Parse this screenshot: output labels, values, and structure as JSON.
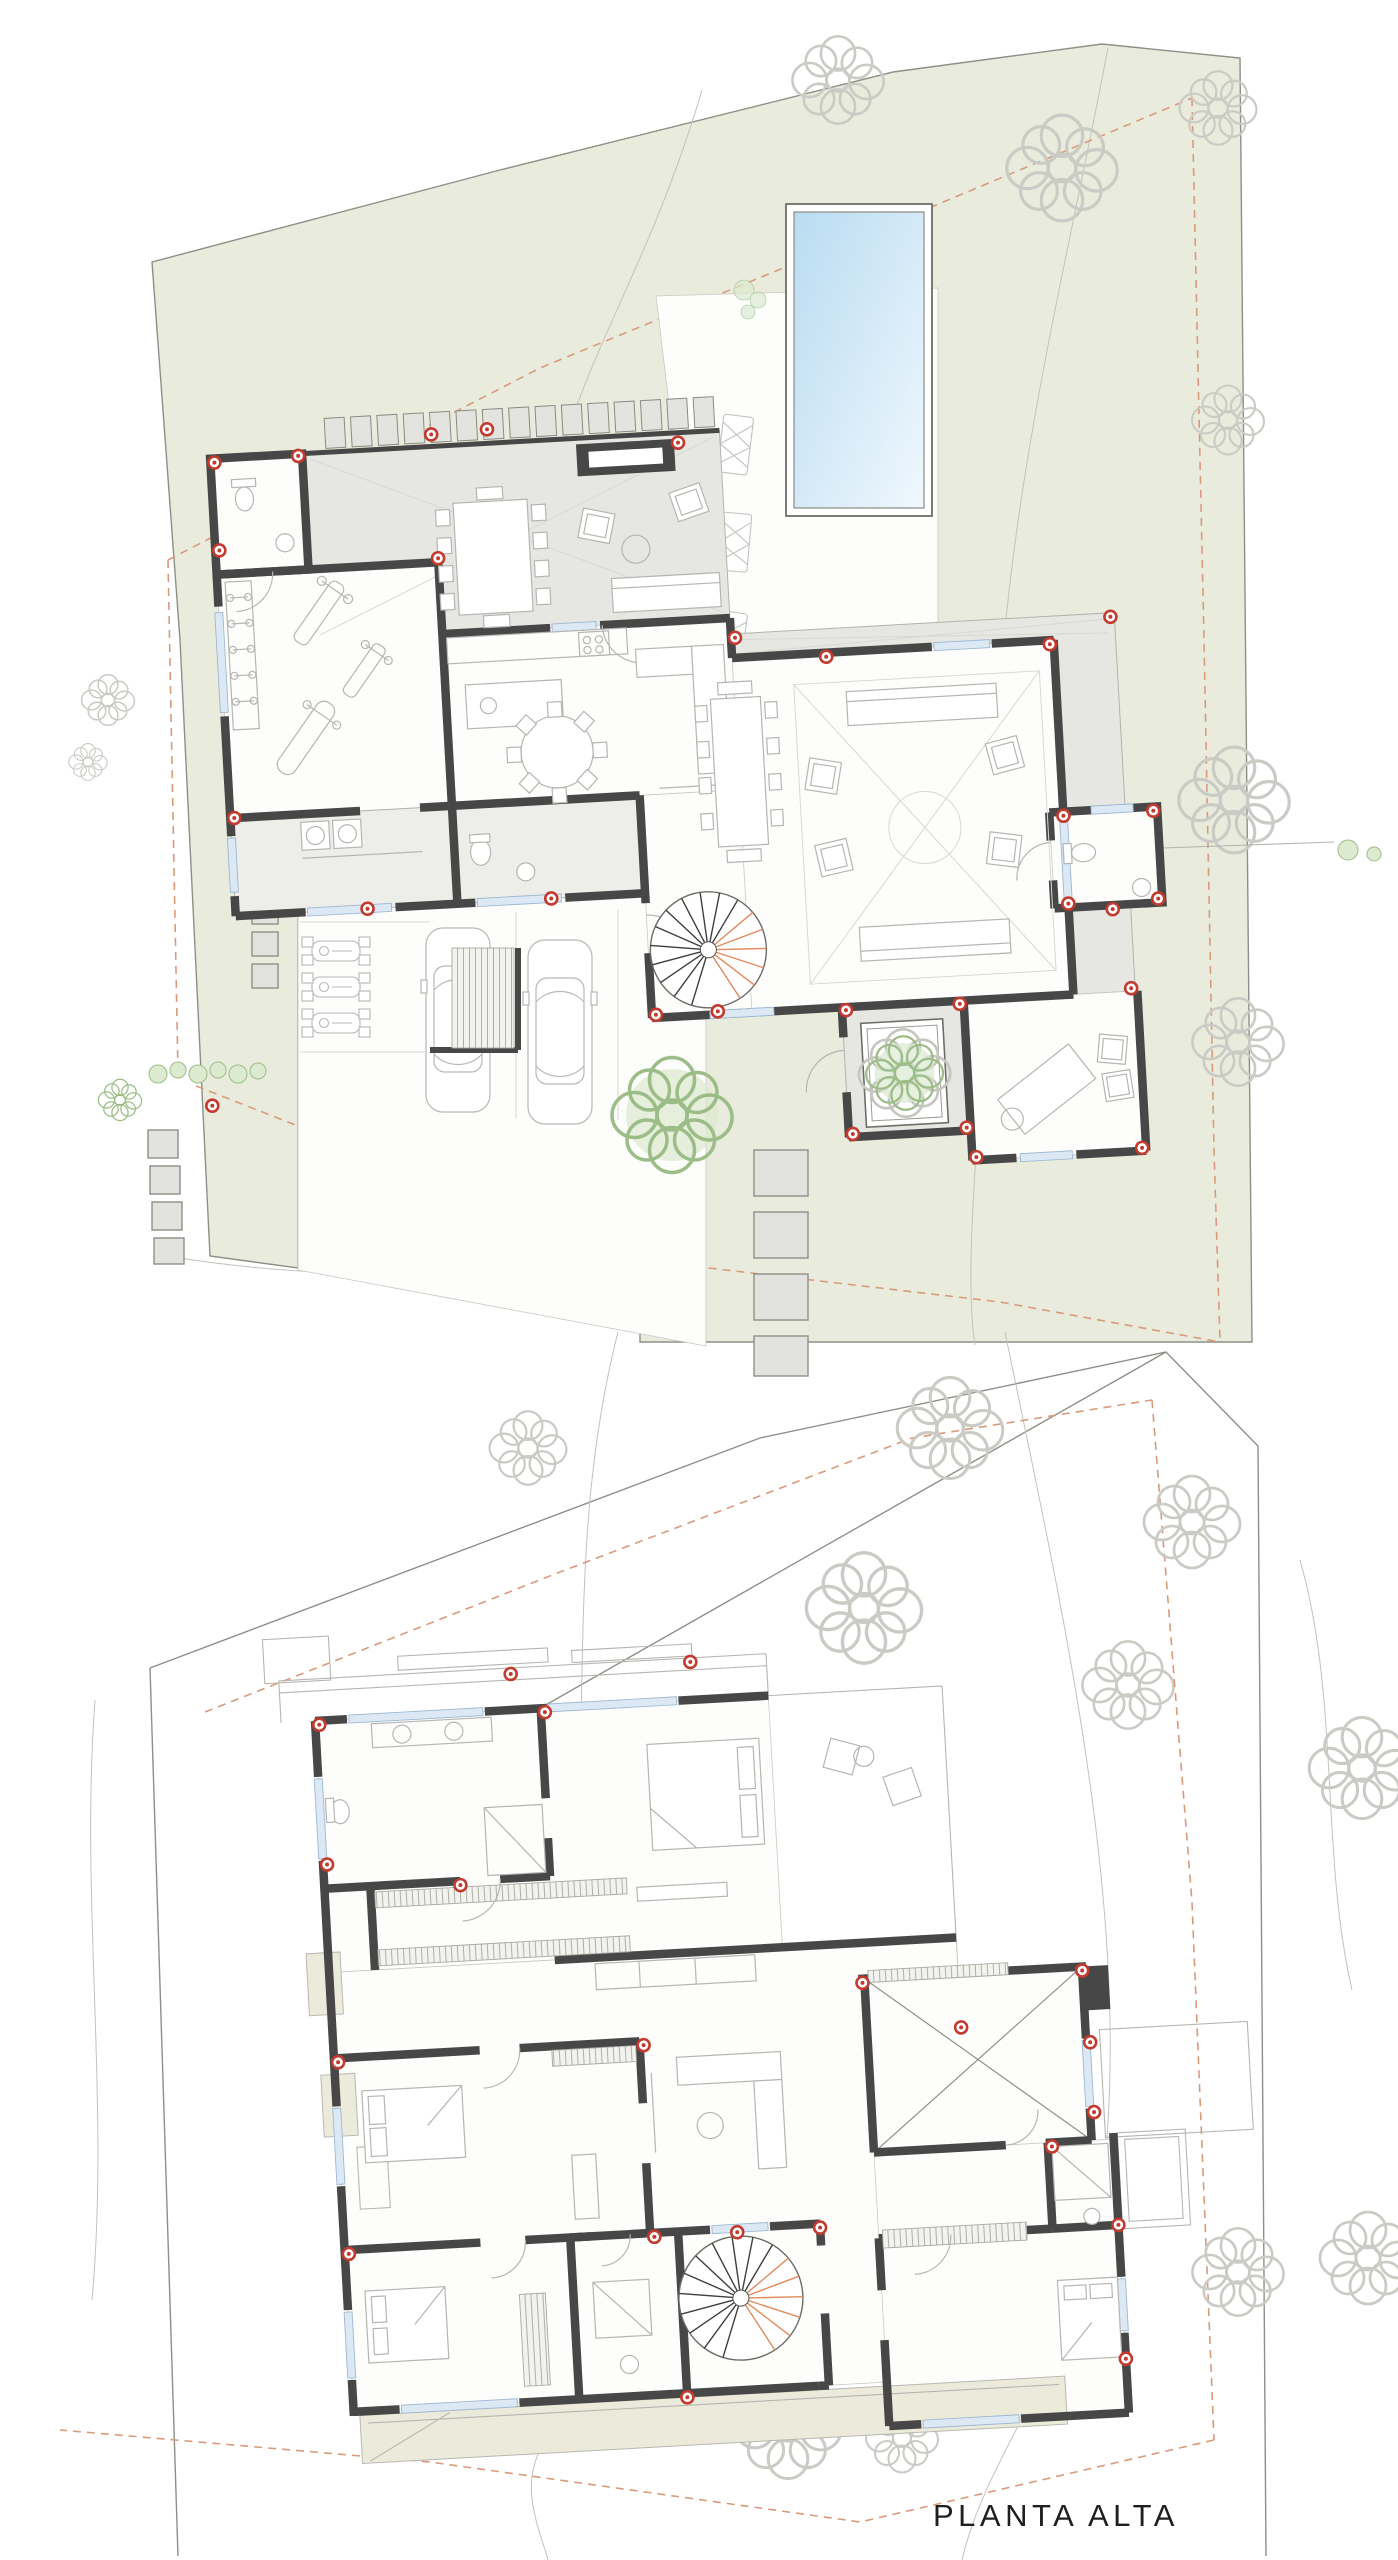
{
  "page": {
    "width": 1398,
    "height": 2560,
    "background": "#ffffff"
  },
  "drawing": {
    "type": "architectural-floor-plans",
    "sheets": [
      {
        "id": "ground-floor-site-plan"
      },
      {
        "id": "upper-floor-plan",
        "label": "PLANTA ALTA"
      }
    ]
  },
  "labels": {
    "upper_floor": "PLANTA ALTA"
  },
  "palette": {
    "paper": "#ffffff",
    "ink": "#1f1f1f",
    "site-green": "#e9ecdc",
    "terrace-gray": "#e6e6e3",
    "laundry-gray": "#ededea",
    "wall-dark": "#474747",
    "line-light": "#b5b5b1",
    "line-faint": "#d8d8d3",
    "boundary": "#8f8f88",
    "setback-dash": "#d99a7c",
    "marker-red": "#c23b2e",
    "glazing-blue": "#9db8d2",
    "pool-blue": "#b9dcf1",
    "pool-blue-light": "#eaf5fb",
    "foliage-green": "#9cbd88",
    "foliage-fill": "#dcead0",
    "stone-gray": "#e2e2de",
    "pergola-gray": "#e3e3e0",
    "stair-accent": "#e08a5e",
    "terrace-band-green": "#ecebdb"
  }
}
